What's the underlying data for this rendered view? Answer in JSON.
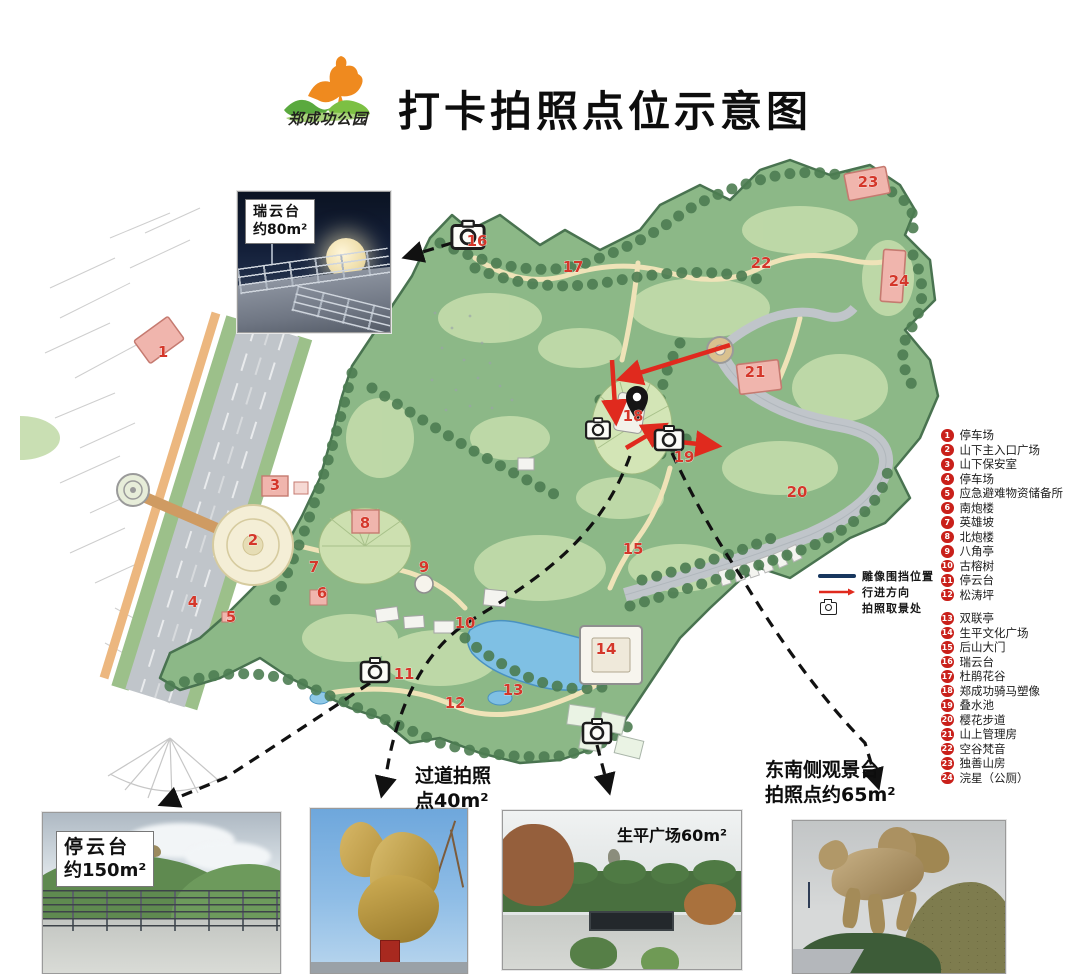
{
  "header": {
    "park_name": "郑成功公园",
    "title": "打卡拍照点位示意图",
    "logo_icon": "horse-rider-over-hills"
  },
  "map_key": {
    "statue": "雕像围挡位置",
    "direction": "行进方向",
    "camera": "拍照取景处"
  },
  "legend": {
    "items": [
      {
        "n": 1,
        "label": "停车场"
      },
      {
        "n": 2,
        "label": "山下主入口广场"
      },
      {
        "n": 3,
        "label": "山下保安室"
      },
      {
        "n": 4,
        "label": "停车场"
      },
      {
        "n": 5,
        "label": "应急避难物资储备所"
      },
      {
        "n": 6,
        "label": "南炮楼"
      },
      {
        "n": 7,
        "label": "英雄坡"
      },
      {
        "n": 8,
        "label": "北炮楼"
      },
      {
        "n": 9,
        "label": "八角亭"
      },
      {
        "n": 10,
        "label": "古榕树"
      },
      {
        "n": 11,
        "label": "停云台"
      },
      {
        "n": 12,
        "label": "松涛坪"
      },
      {
        "n": 13,
        "label": "双联亭"
      },
      {
        "n": 14,
        "label": "生平文化广场"
      },
      {
        "n": 15,
        "label": "后山大门"
      },
      {
        "n": 16,
        "label": "瑞云台"
      },
      {
        "n": 17,
        "label": "杜鹃花谷"
      },
      {
        "n": 18,
        "label": "郑成功骑马塑像"
      },
      {
        "n": 19,
        "label": "叠水池"
      },
      {
        "n": 20,
        "label": "樱花步道"
      },
      {
        "n": 21,
        "label": "山上管理房"
      },
      {
        "n": 22,
        "label": "空谷梵音"
      },
      {
        "n": 23,
        "label": "独善山房"
      },
      {
        "n": 24,
        "label": "浣星（公厕）"
      }
    ],
    "gap_after": 12
  },
  "map": {
    "markers": [
      {
        "n": 1,
        "x": 143,
        "y": 219
      },
      {
        "n": 2,
        "x": 233,
        "y": 407
      },
      {
        "n": 3,
        "x": 255,
        "y": 352
      },
      {
        "n": 4,
        "x": 173,
        "y": 469
      },
      {
        "n": 5,
        "x": 211,
        "y": 484
      },
      {
        "n": 6,
        "x": 302,
        "y": 460
      },
      {
        "n": 7,
        "x": 294,
        "y": 434
      },
      {
        "n": 8,
        "x": 345,
        "y": 390
      },
      {
        "n": 9,
        "x": 404,
        "y": 434
      },
      {
        "n": 10,
        "x": 445,
        "y": 490
      },
      {
        "n": 11,
        "x": 384,
        "y": 541
      },
      {
        "n": 12,
        "x": 435,
        "y": 570
      },
      {
        "n": 13,
        "x": 493,
        "y": 557
      },
      {
        "n": 14,
        "x": 586,
        "y": 516
      },
      {
        "n": 15,
        "x": 613,
        "y": 416
      },
      {
        "n": 16,
        "x": 457,
        "y": 108
      },
      {
        "n": 17,
        "x": 553,
        "y": 134
      },
      {
        "n": 18,
        "x": 613,
        "y": 283
      },
      {
        "n": 19,
        "x": 664,
        "y": 324
      },
      {
        "n": 20,
        "x": 777,
        "y": 359
      },
      {
        "n": 21,
        "x": 735,
        "y": 239
      },
      {
        "n": 22,
        "x": 741,
        "y": 130
      },
      {
        "n": 23,
        "x": 848,
        "y": 49
      },
      {
        "n": 24,
        "x": 879,
        "y": 148
      }
    ],
    "cameras": [
      {
        "x": 448,
        "y": 99,
        "s": 1.15
      },
      {
        "x": 355,
        "y": 534,
        "s": 1.0
      },
      {
        "x": 578,
        "y": 292,
        "s": 0.85
      },
      {
        "x": 649,
        "y": 302,
        "s": 1.0
      },
      {
        "x": 577,
        "y": 595,
        "s": 1.0
      }
    ],
    "pin": {
      "x": 617,
      "y": 266
    }
  },
  "photos": {
    "ruiyuntai": {
      "name": "瑞云台",
      "area": "约80m²"
    },
    "tingyuntai": {
      "name": "停云台",
      "area": "约150m²"
    },
    "corridor": {
      "line1": "过道拍照",
      "line2": "点40m²"
    },
    "shengping": {
      "caption": "生平广场60m²"
    },
    "southeast": {
      "line1": "东南侧观景台",
      "line2": "拍照点约65m²"
    }
  },
  "colors": {
    "marker_red": "#d4372a",
    "badge_red": "#c9201a",
    "arrow_red": "#e02a1e",
    "statue_line_navy": "#17365e",
    "park_green": "#8cb887",
    "road_gray": "#c0c5ca",
    "water_blue": "#7fc0e4"
  }
}
